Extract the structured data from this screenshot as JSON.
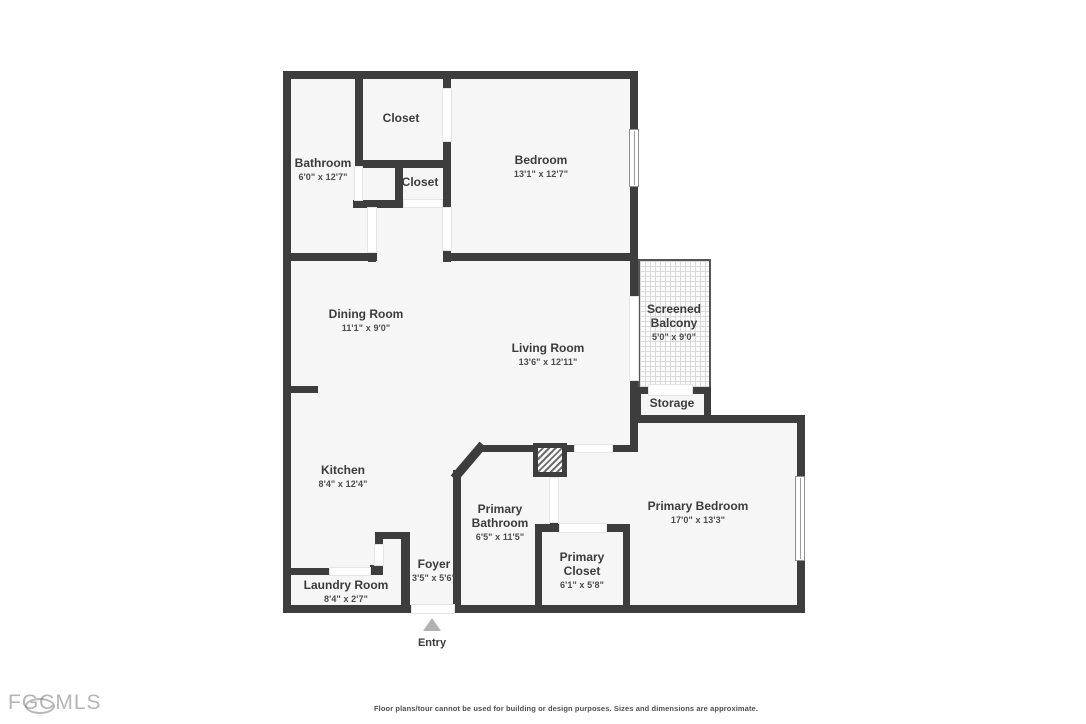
{
  "plan": {
    "rooms": {
      "closet_top": {
        "name": "Closet",
        "dims": ""
      },
      "bathroom": {
        "name": "Bathroom",
        "dims": "6'0\" x 12'7\""
      },
      "closet_small": {
        "name": "Closet",
        "dims": ""
      },
      "bedroom": {
        "name": "Bedroom",
        "dims": "13'1\" x 12'7\""
      },
      "dining_room": {
        "name": "Dining Room",
        "dims": "11'1\" x 9'0\""
      },
      "living_room": {
        "name": "Living Room",
        "dims": "13'6\" x 12'11\""
      },
      "screened_balcony": {
        "name": "Screened Balcony",
        "dims": "5'0\" x 9'0\""
      },
      "storage": {
        "name": "Storage",
        "dims": ""
      },
      "kitchen": {
        "name": "Kitchen",
        "dims": "8'4\" x 12'4\""
      },
      "primary_bathroom": {
        "name": "Primary Bathroom",
        "dims": "6'5\" x 11'5\""
      },
      "primary_closet": {
        "name": "Primary Closet",
        "dims": "6'1\" x 5'8\""
      },
      "primary_bedroom": {
        "name": "Primary Bedroom",
        "dims": "17'0\" x 13'3\""
      },
      "foyer": {
        "name": "Foyer",
        "dims": "3'5\" x 5'6\""
      },
      "laundry_room": {
        "name": "Laundry Room",
        "dims": "8'4\" x 2'7\""
      }
    },
    "entry_label": "Entry"
  },
  "footer": {
    "logo_text": "FGCMLS",
    "disclaimer": "Floor plans/tour cannot be used for building or design purposes. Sizes and dimensions are approximate."
  },
  "colors": {
    "wall": "#3d3d3d",
    "floor": "#f6f6f6",
    "balcony_screen": "#d9d9d9",
    "label_text": "#3b3b3b",
    "logo": "#b5b5b5"
  }
}
